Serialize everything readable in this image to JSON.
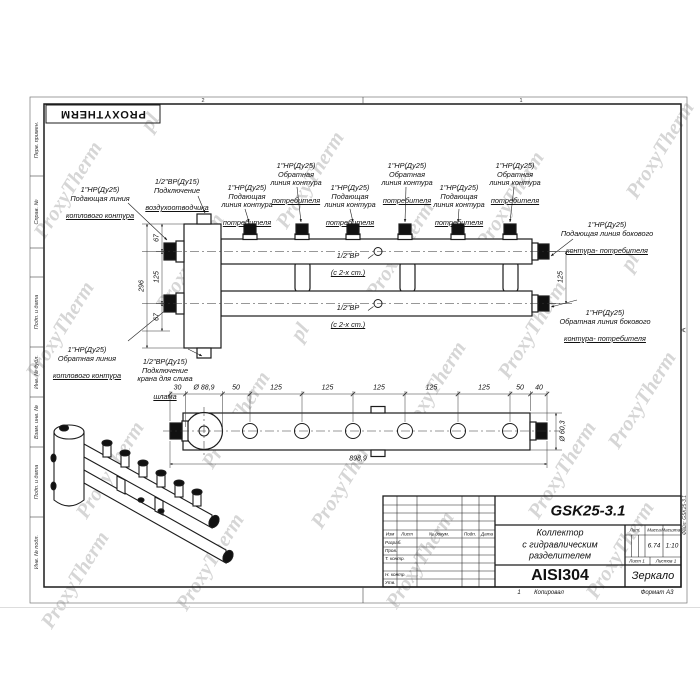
{
  "page": {
    "logo": "PROXYTHERM",
    "watermark": "ProxyTherm",
    "watermark_alt": "pl",
    "zone_top_left": "2",
    "zone_top_right": "1",
    "zone_right_letter": "А",
    "file_ref": "Файл: GSK25-3.1",
    "margin_labels": [
      "Перв. примен.",
      "Справ. №",
      "Подп. и дата",
      "Инв. № дубл.",
      "Взам. инв. №",
      "Подп. и дата",
      "Инв. № подл."
    ]
  },
  "front_view": {
    "labels": {
      "boiler_supply": {
        "lines": [
          "1\"НР(Ду25)",
          "Подающая линия"
        ],
        "shelf": "котлового контура"
      },
      "air_vent": {
        "lines": [
          "1/2\"ВР(Ду15)",
          "Подключение"
        ],
        "shelf": "воздухоотводчика"
      },
      "consumer_supply": {
        "lines": [
          "1\"НР(Ду25)",
          "Подающая",
          "линия контура"
        ],
        "shelf": "потребителя"
      },
      "consumer_return": {
        "lines": [
          "1\"НР(Ду25)",
          "Обратная",
          "линия контура"
        ],
        "shelf": "потребителя"
      },
      "side_supply": {
        "lines": [
          "1\"НР(Ду25)",
          "Подающая линия бокового"
        ],
        "shelf": "контура- потребителя"
      },
      "side_return": {
        "lines": [
          "1\"НР(Ду25)",
          "Обратная линия бокового"
        ],
        "shelf": "контура- потребителя"
      },
      "boiler_return": {
        "lines": [
          "1\"НР(Ду25)",
          "Обратная линия"
        ],
        "shelf": "котлового контура"
      },
      "drain": {
        "lines": [
          "1/2\"ВР(Ду15)",
          "Подключение",
          "крана для слива"
        ],
        "shelf": "шлама"
      },
      "tap": {
        "lines": [
          "1/2\"ВР"
        ],
        "shelf": "(с 2-х ст.)"
      }
    },
    "dims": {
      "top": "67",
      "mid": "125",
      "bot": "67",
      "total": "296",
      "right": "125"
    }
  },
  "top_view": {
    "dims": [
      "30",
      "Ø 88,9",
      "50",
      "125",
      "125",
      "125",
      "125",
      "125",
      "50",
      "40"
    ],
    "overall": "898,9",
    "pipe_dia": "Ø 60,3"
  },
  "title_block": {
    "designation": "GSK25-3.1",
    "name_lines": [
      "Коллектор",
      "с гидравлическим",
      "разделителем"
    ],
    "material": "AISI304",
    "mirror": "Зеркало",
    "col_headers": [
      "Изм",
      "Лист",
      "№ докум.",
      "Подп.",
      "Дата"
    ],
    "row_labels": [
      "Разраб.",
      "Пров.",
      "Т. контр.",
      "Н. контр.",
      "Утв."
    ],
    "lit_label": "Лит.",
    "mass_label": "Масса",
    "scale_label": "Масштаб",
    "mass": "6.74",
    "scale": "1:10",
    "sheet": "Лист 1",
    "sheets": "Листов 1",
    "copy_num": "1",
    "copy_note": "Копировал",
    "format": "Формат А3"
  }
}
